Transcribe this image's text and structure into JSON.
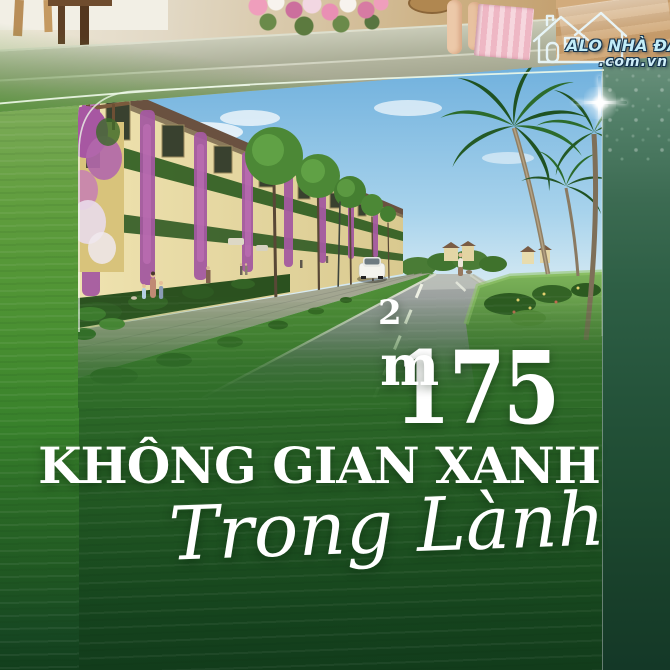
{
  "logo": {
    "icon": "double-house-outline-icon",
    "brand": "ALO NHÀ ĐẤT",
    "domain": ".com.vn"
  },
  "headline": {
    "area_value": "175",
    "area_unit": "m",
    "area_exponent": "2",
    "title": "KHÔNG GIAN XANH",
    "subtitle": "Trong Lành"
  },
  "decor": {
    "sparkle": "four-point-sparkle-icon"
  },
  "colors": {
    "green_bright": "#4f9434",
    "green_dark": "#123c1b",
    "right_panel_teal": "#2e5f45",
    "text_white": "#ffffff",
    "logo_cyan": "#c2ecf8",
    "logo_outline_navy": "#14324c",
    "sky_blue": "#6fb0dd",
    "bougainvillea_purple": "#a755a2",
    "facade_cream": "#ecdfab"
  }
}
